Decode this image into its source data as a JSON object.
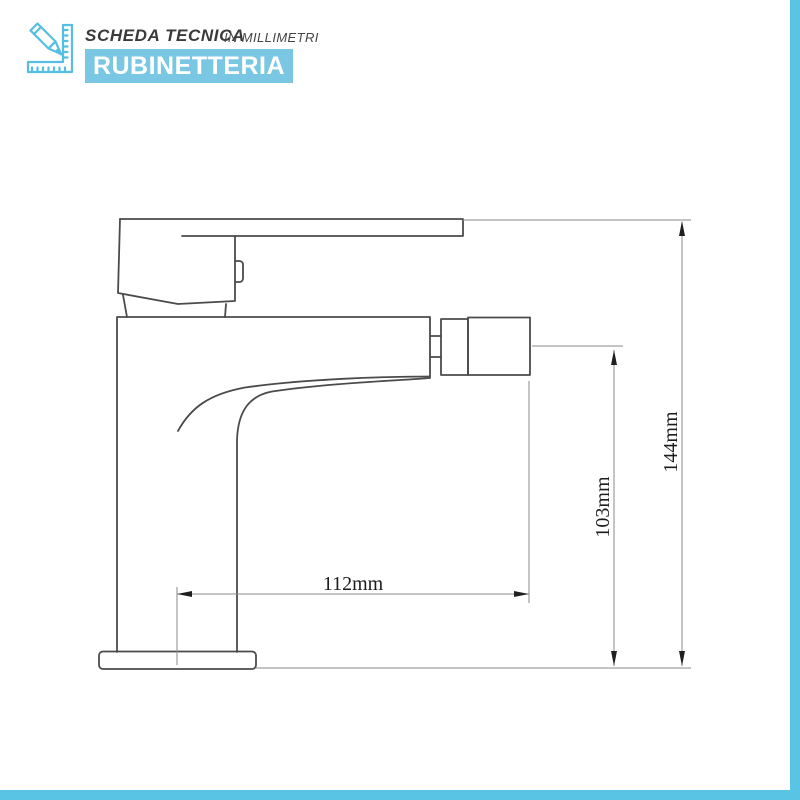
{
  "page": {
    "background": "#ffffff",
    "accent_border_color": "#59c4e4"
  },
  "header": {
    "icon": "pencil-ruler-icon",
    "icon_color": "#55bee2",
    "title": "SCHEDA TECNICA",
    "subtitle": "IN MILLIMETRI",
    "banner": {
      "label": "RUBINETTERIA",
      "background": "#79c7e3",
      "text_color": "#ffffff"
    }
  },
  "drawing": {
    "unit": "mm",
    "line_color": "#4b4b4b",
    "dimension_line_color": "#8a8a8a",
    "dimensions": [
      {
        "label": "112mm",
        "value": 112,
        "axis": "horizontal"
      },
      {
        "label": "103mm",
        "value": 103,
        "axis": "vertical"
      },
      {
        "label": "144mm",
        "value": 144,
        "axis": "vertical"
      }
    ]
  }
}
